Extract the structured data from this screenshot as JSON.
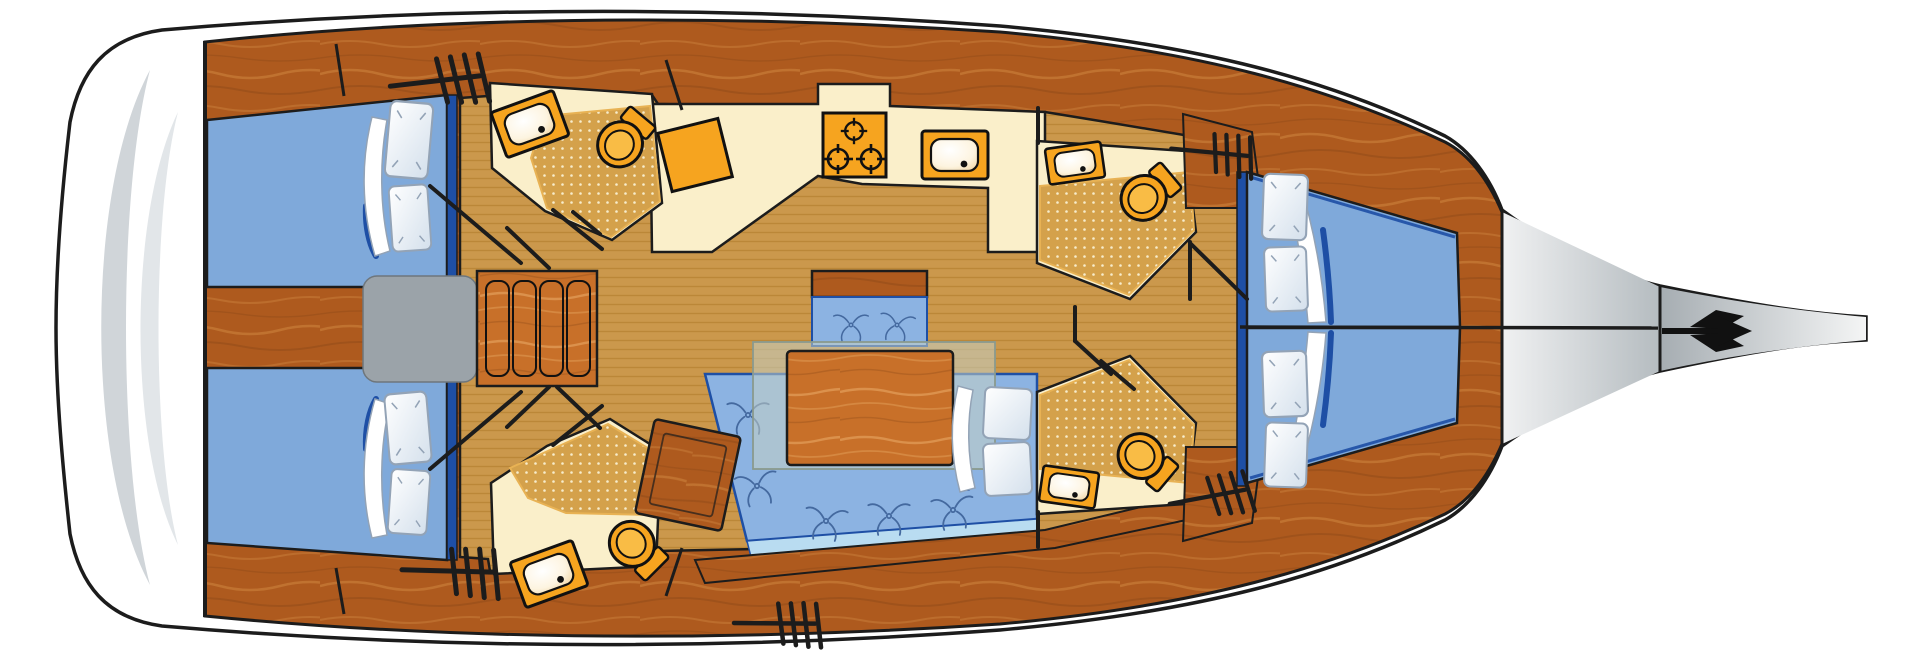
{
  "document": {
    "title": "Sailing yacht interior layout plan — overhead view, bow to the right"
  },
  "palette": {
    "outline": "#1c1c1c",
    "wood1": "#ae5a1e",
    "wood2": "#c87c38",
    "wood3": "#8f4917",
    "woodL1": "#c87029",
    "woodL2": "#e09a55",
    "floor1": "#cb984c",
    "floor2": "#b98434",
    "cream": "#faefca",
    "shower1": "#d4a14b",
    "showerDot": "#f7eccb",
    "showerEdge": "#e8b254",
    "orange": "#f6a41f",
    "orange2": "#f9bc45",
    "bedBlue": "#7fa9da",
    "cushionBlue": "#8cb3e2",
    "navy": "#1e4fa5",
    "stripBlue": "#b9dcf1",
    "motif": "#44699f",
    "pillowStroke": "#93a3b6",
    "pillowLo": "#d4e0ec",
    "grayBox": "#9ba3a9",
    "glass": "#c4cfc5",
    "basinEdge": "#f0d39e",
    "platformArc": "#d0d5d9",
    "platformArc2": "#e2e6e9",
    "bow1": "#f0f1f2",
    "bow2": "#b5bcc0",
    "bow3": "#a6adb2",
    "bow4": "#f4f5f5"
  },
  "vessel": {
    "view": "overhead-floorplan",
    "bow_direction": "right",
    "areas": [
      {
        "id": "swim-platform",
        "fixtures": []
      },
      {
        "id": "aft-cabin-port",
        "fixtures": [
          "double-berth",
          "pillow",
          "pillow",
          "duvet"
        ]
      },
      {
        "id": "aft-cabin-starboard",
        "fixtures": [
          "double-berth",
          "pillow",
          "pillow",
          "duvet"
        ]
      },
      {
        "id": "aft-head-port",
        "fixtures": [
          "sink",
          "toilet",
          "shower-floor"
        ]
      },
      {
        "id": "aft-head-starboard",
        "fixtures": [
          "sink",
          "toilet",
          "shower-floor"
        ]
      },
      {
        "id": "companionway",
        "fixtures": [
          "engine-box",
          "ladder-steps"
        ]
      },
      {
        "id": "galley",
        "fixtures": [
          "worktop",
          "stove-3-burners",
          "sink"
        ]
      },
      {
        "id": "chart-table",
        "fixtures": [
          "table"
        ]
      },
      {
        "id": "salon",
        "fixtures": [
          "settee-forward",
          "settee-aft",
          "table",
          "glass-panel",
          "pillow",
          "pillow",
          "duvet"
        ]
      },
      {
        "id": "forward-head-port",
        "fixtures": [
          "sink",
          "toilet",
          "shower-floor"
        ]
      },
      {
        "id": "forward-head-starboard",
        "fixtures": [
          "sink",
          "toilet",
          "shower-floor"
        ]
      },
      {
        "id": "forward-cabin",
        "fixtures": [
          "v-berth-port",
          "v-berth-starboard",
          "pillow",
          "pillow",
          "pillow",
          "pillow",
          "duvet",
          "duvet"
        ]
      },
      {
        "id": "bow-deck",
        "fixtures": [
          "bowsprit",
          "trident-logo"
        ]
      }
    ],
    "icons": [
      "trident-logo",
      "hatch-steps-icon",
      "burner-icon",
      "toilet-icon",
      "sink-icon",
      "seat-motif-icon",
      "ladder-icon"
    ]
  }
}
